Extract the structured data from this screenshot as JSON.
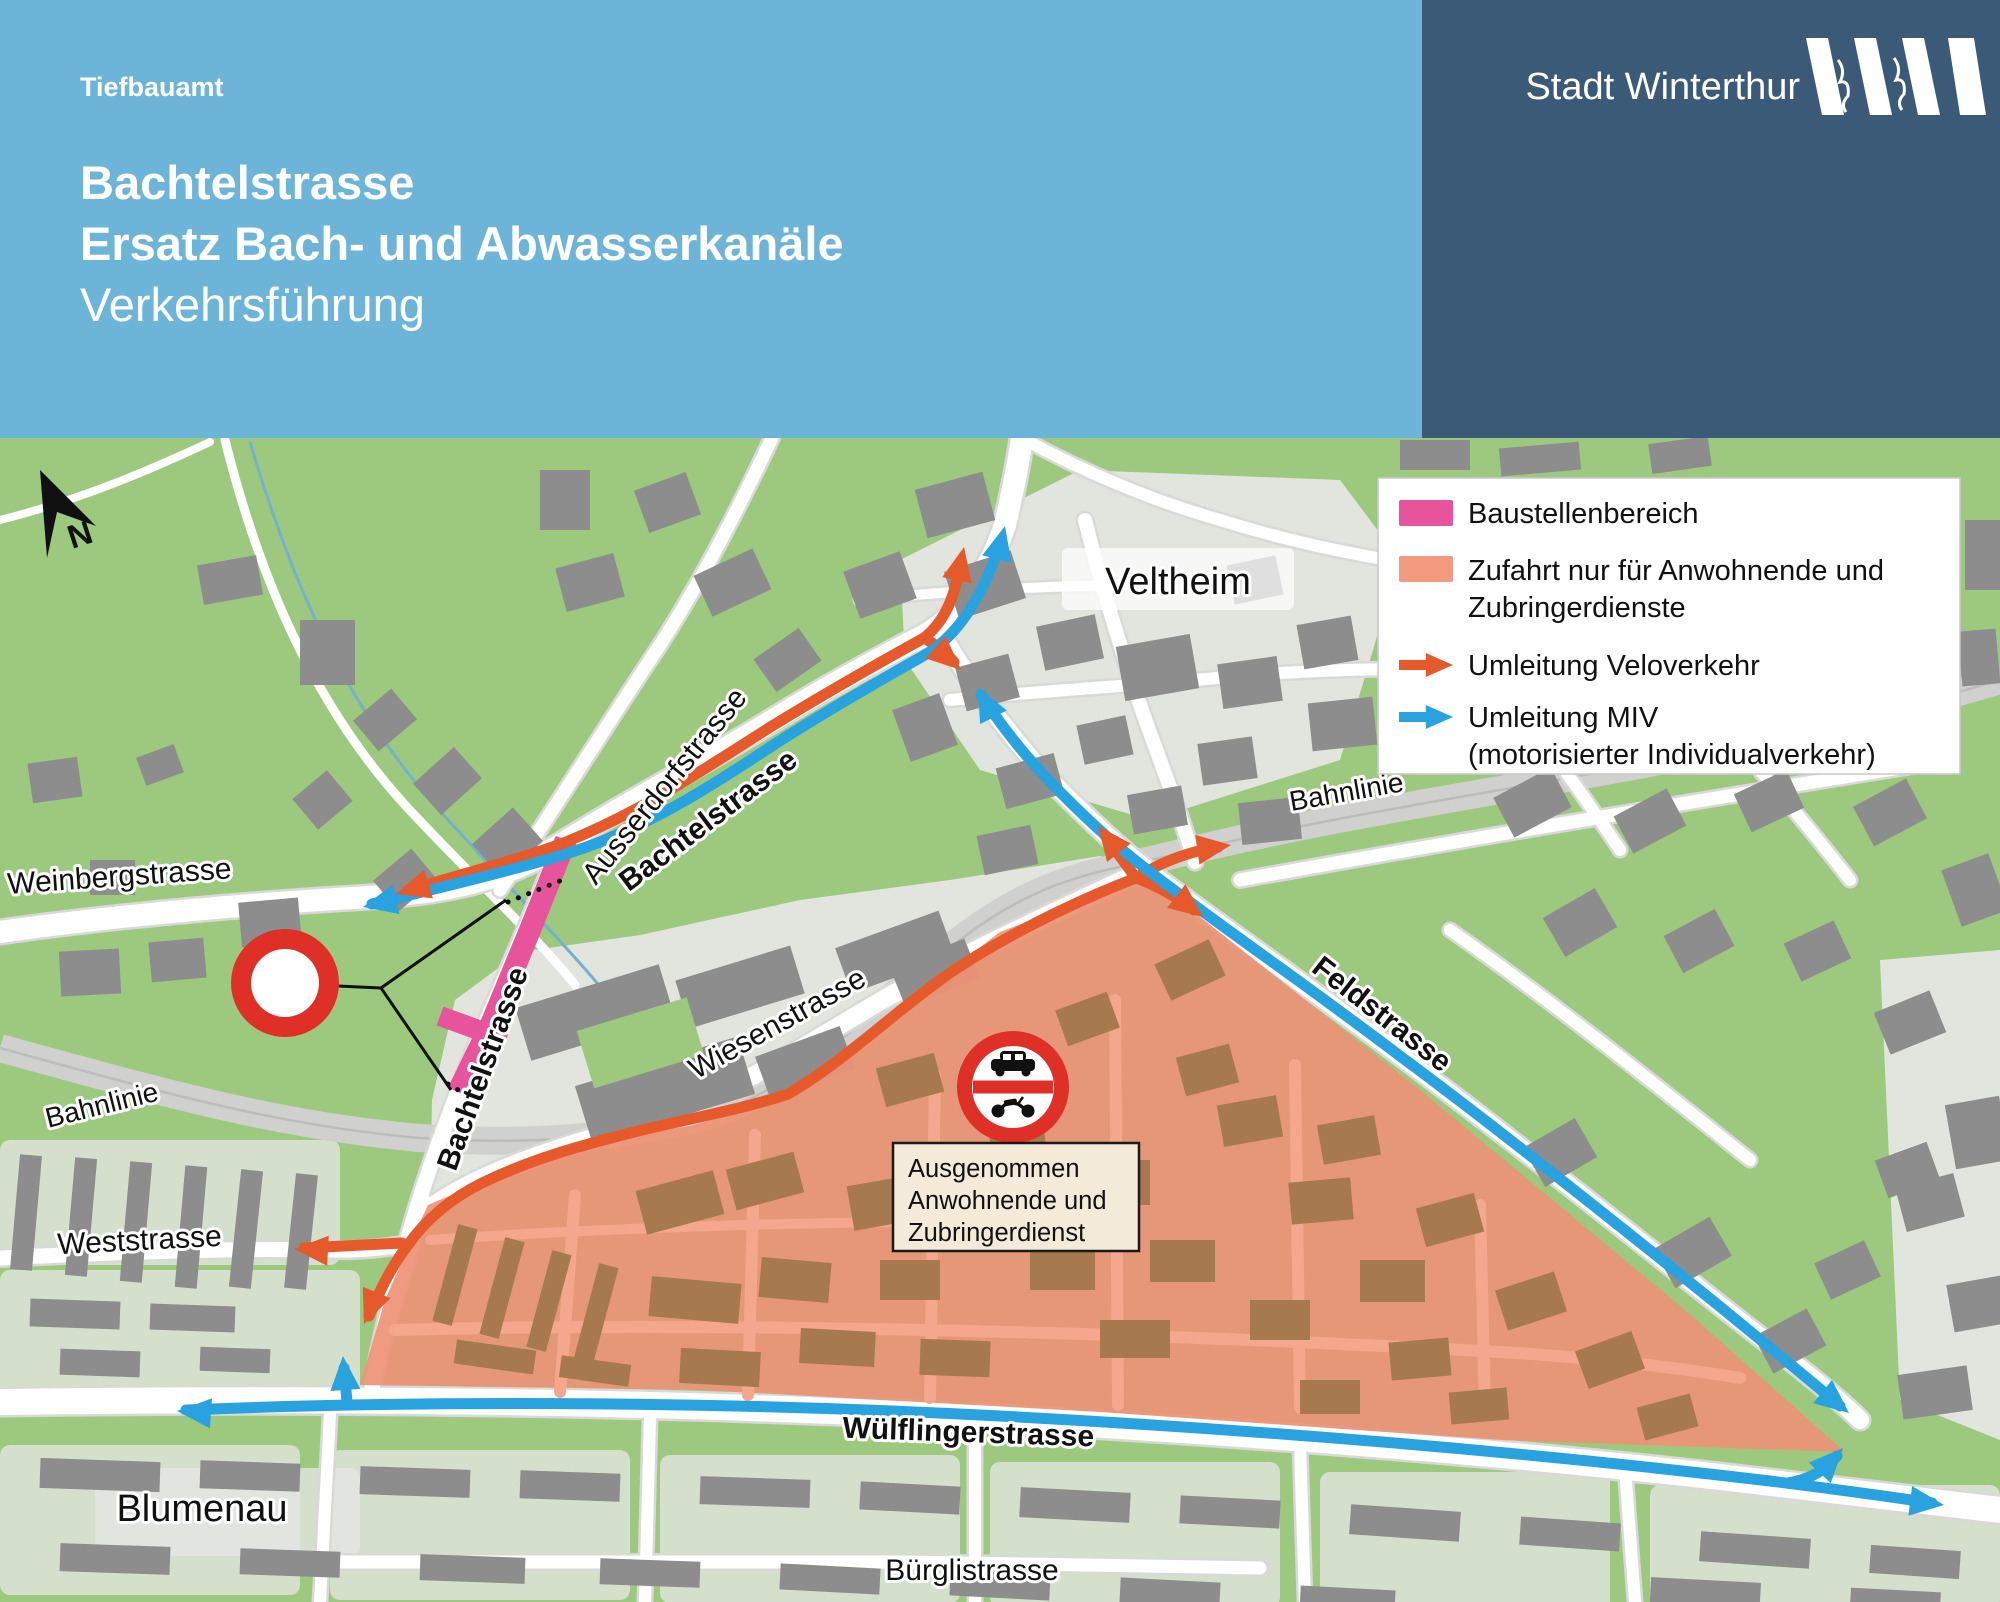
{
  "header": {
    "department": "Tiefbauamt",
    "title_line1": "Bachtelstrasse",
    "title_line2": "Ersatz Bach- und Abwasserkanäle",
    "subtitle": "Verkehrsführung",
    "logo_text": "Stadt Winterthur"
  },
  "legend": {
    "items": [
      {
        "type": "swatch",
        "color_key": "pink",
        "label": "Baustellenbereich"
      },
      {
        "type": "swatch",
        "color_key": "salmon_light",
        "label": "Zufahrt nur für Anwohnende und",
        "label2": "Zubringerdienste"
      },
      {
        "type": "arrow",
        "color_key": "orange",
        "label": "Umleitung Veloverkehr"
      },
      {
        "type": "arrow",
        "color_key": "blue",
        "label": "Umleitung MIV",
        "label2": "(motorisierter Individualverkehr)"
      }
    ]
  },
  "map": {
    "north_label": "N",
    "exception_sign": {
      "lines": [
        "Ausgenommen",
        "Anwohnende und",
        "Zubringerdienst"
      ]
    },
    "icons": [
      {
        "name": "north-arrow-icon"
      },
      {
        "name": "no-entry-sign"
      },
      {
        "name": "no-motor-vehicles-sign"
      }
    ],
    "labels": [
      {
        "id": "weinbergstrasse",
        "text": "Weinbergstrasse",
        "x": 120,
        "y": 886,
        "rot": -4,
        "size": 30,
        "bold": false
      },
      {
        "id": "ausserdorfstrasse",
        "text": "Ausserdorfstrasse",
        "x": 672,
        "y": 792,
        "rot": -51,
        "size": 30,
        "bold": false
      },
      {
        "id": "bachtelstrasse-nord",
        "text": "Bachtelstrasse",
        "x": 714,
        "y": 828,
        "rot": -37,
        "size": 30,
        "bold": true
      },
      {
        "id": "bachtelstrasse-sued",
        "text": "Bachtelstrasse",
        "x": 492,
        "y": 1072,
        "rot": -70,
        "size": 30,
        "bold": true
      },
      {
        "id": "bahnlinie-west",
        "text": "Bahnlinie",
        "x": 104,
        "y": 1114,
        "rot": -14,
        "size": 28,
        "bold": false
      },
      {
        "id": "bahnlinie-ost",
        "text": "Bahnlinie",
        "x": 1348,
        "y": 801,
        "rot": -10,
        "size": 28,
        "bold": false
      },
      {
        "id": "veltheim",
        "text": "Veltheim",
        "x": 1178,
        "y": 594,
        "rot": 0,
        "size": 38,
        "bold": false
      },
      {
        "id": "wiesenstrasse",
        "text": "Wiesenstrasse",
        "x": 782,
        "y": 1032,
        "rot": -29,
        "size": 30,
        "bold": false
      },
      {
        "id": "feldstrasse",
        "text": "Feldstrasse",
        "x": 1376,
        "y": 1022,
        "rot": 38,
        "size": 30,
        "bold": true
      },
      {
        "id": "weststrasse",
        "text": "Weststrasse",
        "x": 140,
        "y": 1250,
        "rot": -3,
        "size": 30,
        "bold": false
      },
      {
        "id": "wuelflingerstrasse",
        "text": "Wülflingerstrasse",
        "x": 968,
        "y": 1442,
        "rot": 2,
        "size": 30,
        "bold": true
      },
      {
        "id": "blumenau",
        "text": "Blumenau",
        "x": 202,
        "y": 1521,
        "rot": 0,
        "size": 38,
        "bold": false
      },
      {
        "id": "buerglistrasse",
        "text": "Bürglistrasse",
        "x": 972,
        "y": 1580,
        "rot": 0,
        "size": 30,
        "bold": false
      }
    ]
  },
  "colors": {
    "light_blue": "#6cb5d9",
    "dark_blue": "#3b5a78",
    "green": "#9cc97e",
    "block": "#e7e7e5",
    "road": "#ffffff",
    "casing": "#d9d9d7",
    "rail": "#d0d0ce",
    "rail_line": "#bcbcba",
    "building": "#8d8d8d",
    "salmon": "#ed9276",
    "salmon_light": "#f29b80",
    "salmon_road": "#f4a78c",
    "zone_building": "#a6794e",
    "pink": "#e7549b",
    "orange": "#e6592b",
    "blue": "#29a2e0",
    "red": "#df3028",
    "beige": "#f3ead9",
    "ink": "#111111",
    "stream": "#74b0d0"
  }
}
